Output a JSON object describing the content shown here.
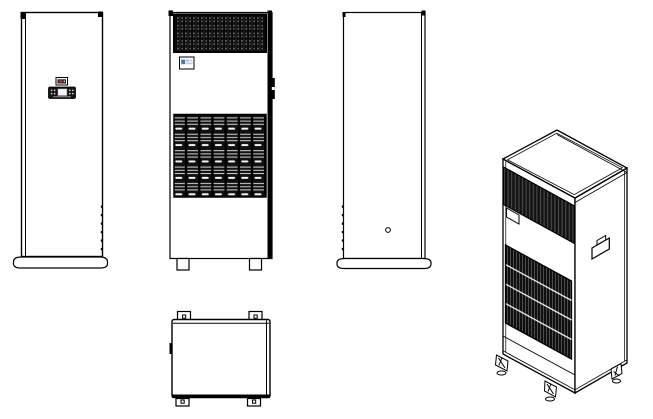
{
  "page": {
    "background": "#ffffff"
  },
  "drawing": {
    "subject": "Floor-standing cabinet air conditioning unit - multi-view technical line drawing",
    "views": [
      {
        "id": "front-view-panel",
        "label": "Front view with controller panel and pedestal base"
      },
      {
        "id": "front-view-grilles",
        "label": "Front view with intake and outlet air grilles"
      },
      {
        "id": "side-view",
        "label": "Side view with port hole and pedestal base"
      },
      {
        "id": "top-view",
        "label": "Top view with mounting tabs"
      },
      {
        "id": "isometric-view",
        "label": "Isometric view with grilles, side handle and casters"
      }
    ],
    "components": {
      "controller": "LCD controller with buttons",
      "indicator_badge": "status indicator badge",
      "brand_label": "blue brand label",
      "top_grille": "perforated outlet grille",
      "louver_grille": "louvered intake grille",
      "side_handle": "recessed side handle",
      "port_hole": "side port hole",
      "mounting_tabs": "4 mounting tabs with holes",
      "feet": "2 square feet",
      "casters": "3 caster feet"
    },
    "colors": {
      "line": "#000000",
      "fill": "#ffffff",
      "grille_dark": "#0d0d0d",
      "grille_dot": "#8f8f8f",
      "logo_blue": "#4a7ab5",
      "logo_blue_light": "#9ab7d8",
      "indicator_red": "#c0392b",
      "controller_body": "#141414",
      "display_white": "#f5f5f5"
    }
  }
}
